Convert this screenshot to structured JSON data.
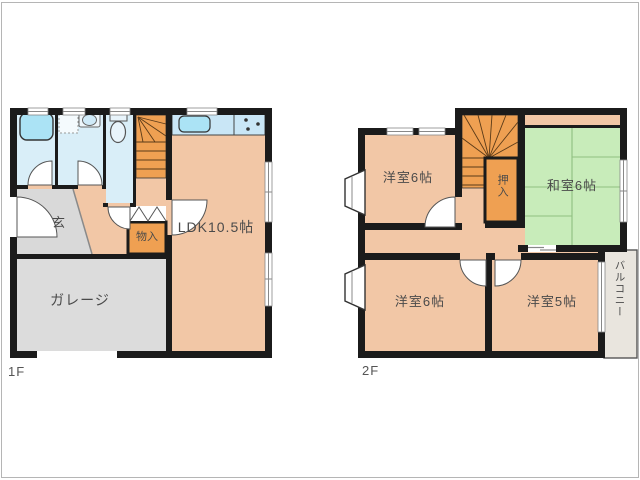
{
  "document_type": "floor-plan",
  "floor1": {
    "label": "1F",
    "rooms": {
      "ldk": "LDK10.5帖",
      "entrance": "玄",
      "storage": "物入",
      "garage": "ガレージ"
    }
  },
  "floor2": {
    "label": "2F",
    "rooms": {
      "western_room_top": "洋室6帖",
      "japanese_room": "和室6帖",
      "closet": "押入",
      "western_room_bottom_left": "洋室6帖",
      "western_room_bottom_right": "洋室5帖",
      "balcony": "バルコニー"
    }
  },
  "colors": {
    "wall": "#1b1b1b",
    "room_peach": "#f2c7a6",
    "tatami_green": "#c8ecba",
    "water_blue": "#d9eef8",
    "fixture_blue": "#abe3f5",
    "stairs_orange": "#efa052",
    "gray_area": "#dcdcdc",
    "balcony_fill": "#e9e5de"
  }
}
